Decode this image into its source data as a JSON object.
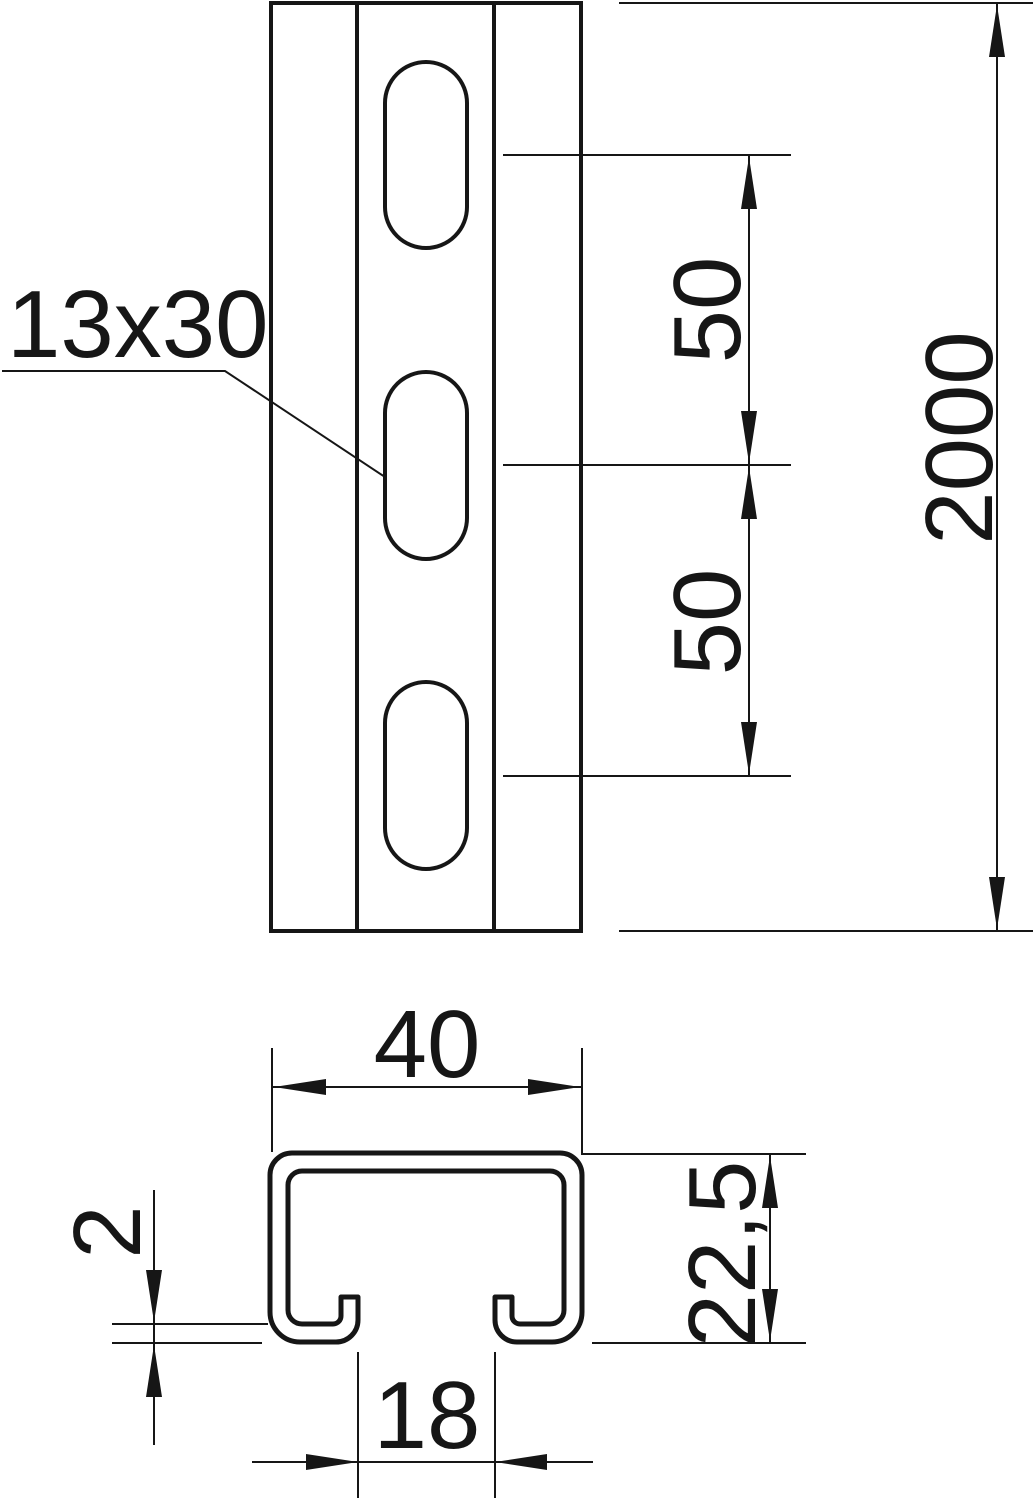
{
  "drawing": {
    "colors": {
      "line": "#161616",
      "background": "#ffffff"
    },
    "front_view": {
      "slot_label": "13x30",
      "slot_pitch_upper": "50",
      "slot_pitch_lower": "50",
      "total_length": "2000"
    },
    "cross_section": {
      "outer_width": "40",
      "profile_height": "22,5",
      "material_thickness": "2",
      "slot_opening": "18"
    }
  }
}
